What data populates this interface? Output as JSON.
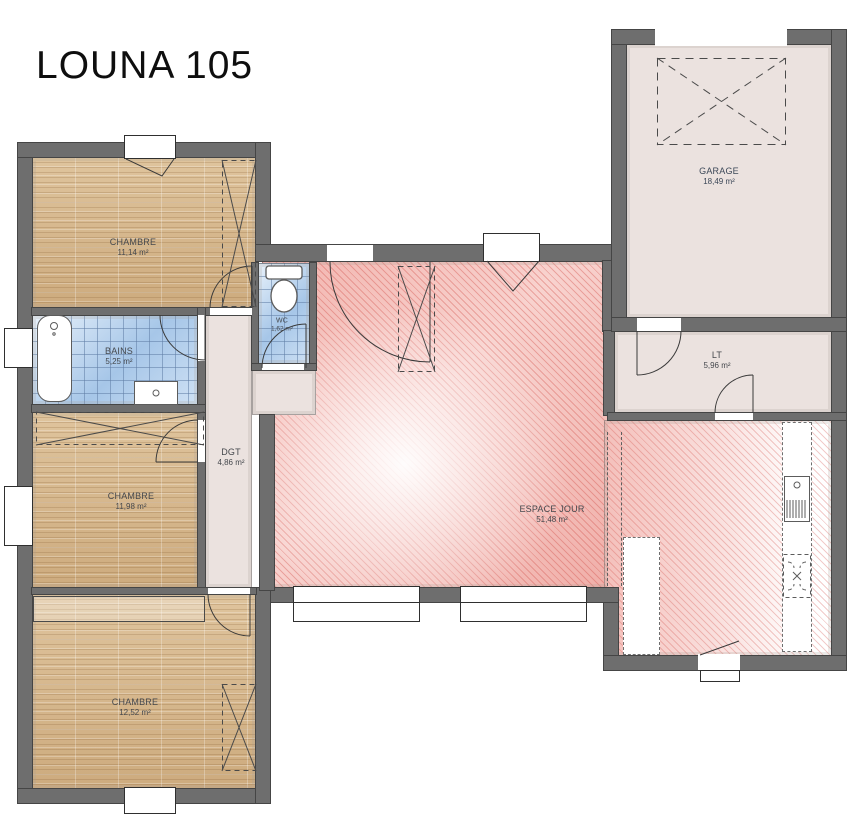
{
  "title": "LOUNA 105",
  "rooms": {
    "chambre1": {
      "name": "CHAMBRE",
      "area": "11,14 m²"
    },
    "bains": {
      "name": "BAINS",
      "area": "5,25 m²"
    },
    "wc": {
      "name": "WC",
      "area": "1,62 m²"
    },
    "dgt": {
      "name": "DGT",
      "area": "4,86 m²"
    },
    "chambre2": {
      "name": "CHAMBRE",
      "area": "11,98 m²"
    },
    "chambre3": {
      "name": "CHAMBRE",
      "area": "12,52 m²"
    },
    "espace_jour": {
      "name": "ESPACE JOUR",
      "area": "51,48 m²"
    },
    "lt": {
      "name": "LT",
      "area": "5,96 m²"
    },
    "garage": {
      "name": "GARAGE",
      "area": "18,49 m²"
    }
  },
  "colors": {
    "wall": "#6e6e6e",
    "wood_floor": "#d8bb93",
    "tile_floor": "#b7d2ec",
    "living_pink": "#f2b9b4",
    "service_floor": "#ebe2df"
  }
}
